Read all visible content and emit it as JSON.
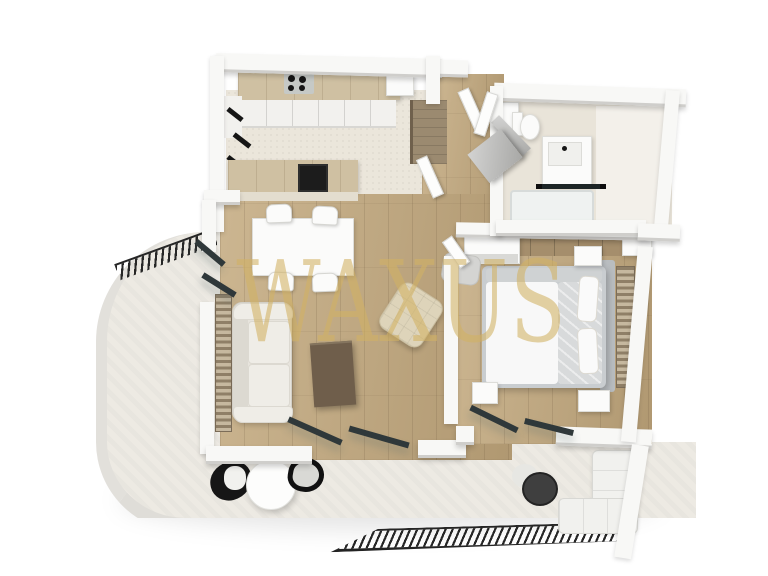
{
  "image_type": "3D rendered top-down floor plan of a one-bedroom apartment with wrap-around terrace",
  "watermark": {
    "text": "WAXUS",
    "color": "#d2b264"
  },
  "palette": {
    "background": "#ffffff",
    "terrace_floor": "#edeae3",
    "terrace_rim": "#e2e0db",
    "kitchen_floor": "#ebe6db",
    "wood_light": "#ccb691",
    "wood_dark": "#b09871",
    "wall_top": "#f8f8f6",
    "wall_edge": "#cfcecb",
    "slat_wood": "#8f7f67",
    "counter_wood": "#cfc0a2",
    "cabinet_white": "#f2f1ee",
    "sofa": "#e7e4dd",
    "bed_frame": "#c9cdd0",
    "bed_duvet": "#f8f8f8",
    "blanket": "#d8dadb",
    "coffee_table": "#6f5e4b",
    "pouf": "#ded4ba",
    "black": "#1e1e1e",
    "glass_dark": "#2f383a",
    "bath_floor": "#e9e4d9",
    "tub": "#eff2f1",
    "gold": "#d2b264"
  },
  "scene": {
    "rooms": [
      {
        "name": "kitchen",
        "items": [
          "wood worktop with 4-burner cooktop",
          "white sink",
          "white base cabinets",
          "kitchen island with dark sink",
          "black wall hooks",
          "tall wood cabinet"
        ]
      },
      {
        "name": "dining-area",
        "items": [
          "white rectangular table",
          "four white chairs"
        ]
      },
      {
        "name": "living-room",
        "items": [
          "light fabric sofa",
          "dark wood coffee table",
          "beige tufted pouf",
          "wood slat wall panels",
          "open sliding glass doors"
        ]
      },
      {
        "name": "hallway",
        "items": [
          "entrance door leaves",
          "leaning gray mirror panel",
          "wood floor"
        ]
      },
      {
        "name": "bathroom",
        "items": [
          "toilet",
          "wall shelf",
          "vanity washbasin unit",
          "bathtub",
          "black-framed glass partition",
          "open gray door"
        ]
      },
      {
        "name": "storage-closet",
        "items": [
          "wood shelving"
        ]
      },
      {
        "name": "bedroom",
        "items": [
          "double bed with white duvet and gray blanket",
          "gray headboard",
          "wood slat headboard panel",
          "two nightstands",
          "wardrobe",
          "gray armchair",
          "bedside bench",
          "open glass terrace door"
        ]
      },
      {
        "name": "terrace",
        "items": [
          "two black bistro chairs",
          "round white table",
          "round dark side table",
          "white outdoor sectional",
          "black hatched railings",
          "curved concrete slab edge"
        ]
      }
    ]
  }
}
